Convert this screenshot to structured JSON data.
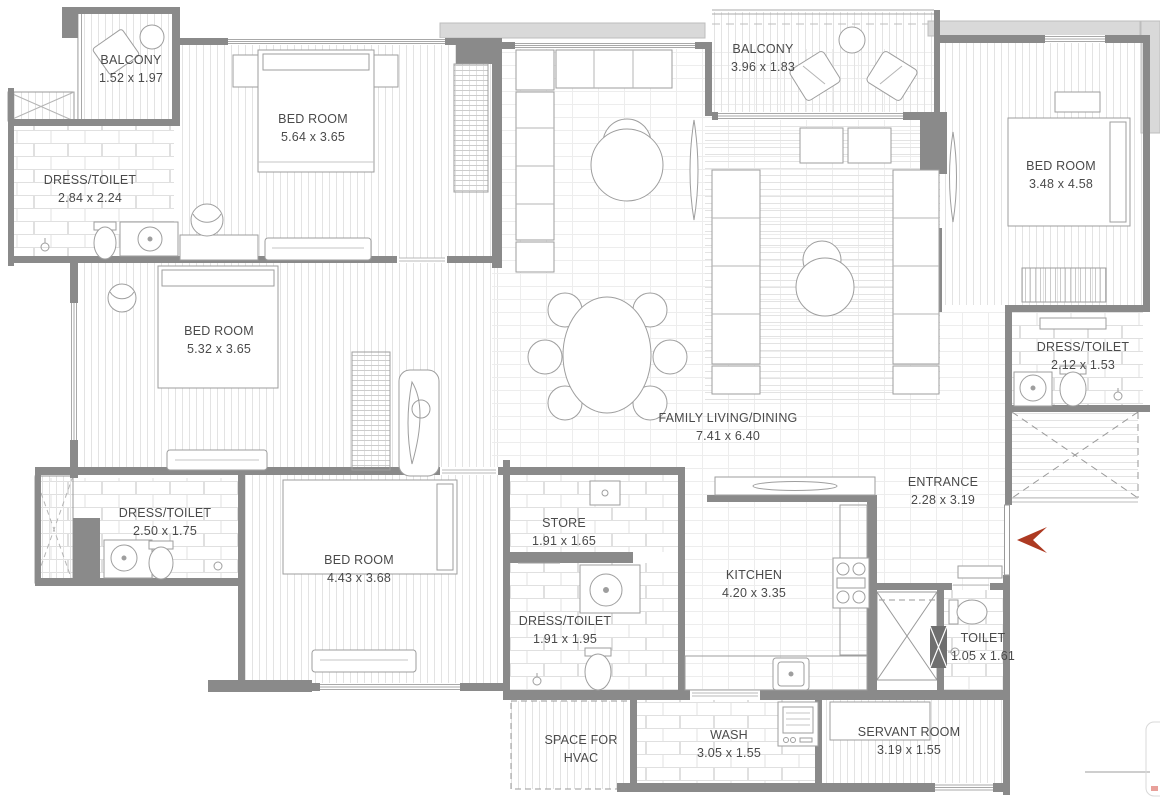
{
  "marker": {
    "color": "#ad3a22"
  },
  "rooms": [
    {
      "id": "balcony-1",
      "line1": "BALCONY",
      "line2": "1.52 x 1.97"
    },
    {
      "id": "bedroom-1",
      "line1": "BED ROOM",
      "line2": "5.64 x 3.65"
    },
    {
      "id": "dress-toilet-1",
      "line1": "DRESS/TOILET",
      "line2": "2.84 x 2.24"
    },
    {
      "id": "balcony-2",
      "line1": "BALCONY",
      "line2": "3.96 x 1.83"
    },
    {
      "id": "bedroom-2",
      "line1": "BED ROOM",
      "line2": "3.48 x 4.58"
    },
    {
      "id": "bedroom-3",
      "line1": "BED ROOM",
      "line2": "5.32 x 3.65"
    },
    {
      "id": "dress-toilet-2",
      "line1": "DRESS/TOILET",
      "line2": "2.50 x 1.75"
    },
    {
      "id": "bedroom-4",
      "line1": "BED ROOM",
      "line2": "4.43 x 3.68"
    },
    {
      "id": "family-living",
      "line1": "FAMILY LIVING/DINING",
      "line2": "7.41 x 6.40"
    },
    {
      "id": "dress-toilet-3",
      "line1": "DRESS/TOILET",
      "line2": "2.12 x 1.53"
    },
    {
      "id": "entrance",
      "line1": "ENTRANCE",
      "line2": "2.28 x 3.19"
    },
    {
      "id": "store",
      "line1": "STORE",
      "line2": "1.91 x 1.65"
    },
    {
      "id": "kitchen",
      "line1": "KITCHEN",
      "line2": "4.20 x 3.35"
    },
    {
      "id": "dress-toilet-4",
      "line1": "DRESS/TOILET",
      "line2": "1.91 x 1.95"
    },
    {
      "id": "toilet",
      "line1": "TOILET",
      "line2": "1.05 x 1.61"
    },
    {
      "id": "hvac",
      "line1": "SPACE FOR",
      "line2": "HVAC"
    },
    {
      "id": "wash",
      "line1": "WASH",
      "line2": "3.05 x 1.55"
    },
    {
      "id": "servant-room",
      "line1": "SERVANT ROOM",
      "line2": "3.19 x 1.55"
    }
  ]
}
